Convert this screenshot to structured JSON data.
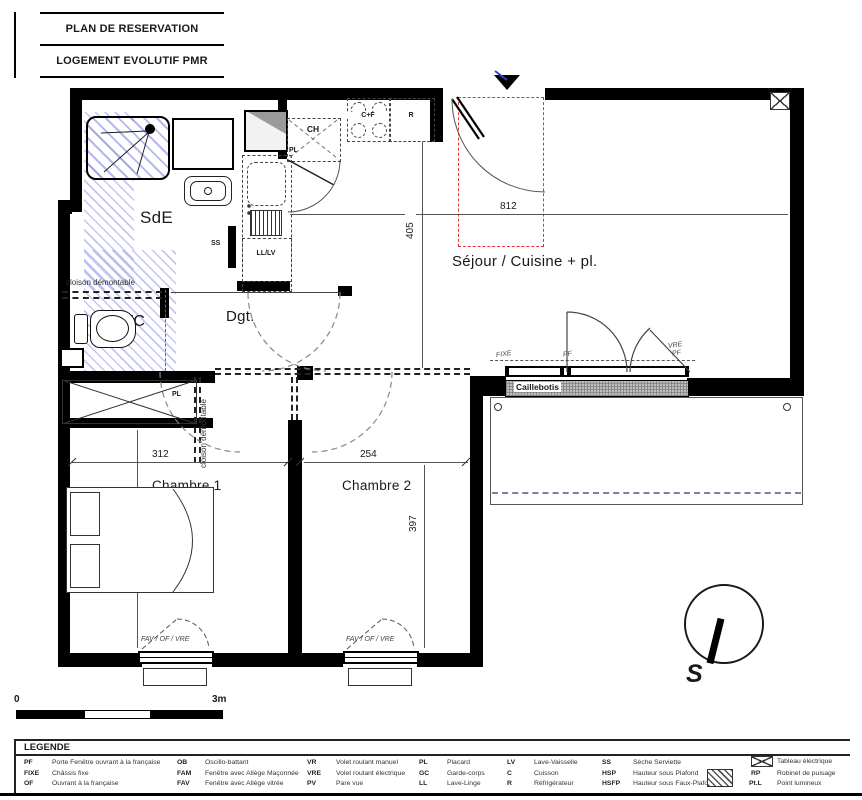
{
  "title_block": {
    "line1": "PLAN DE RESERVATION",
    "line2": "LOGEMENT EVOLUTIF PMR"
  },
  "rooms": {
    "sde": "SdE",
    "wc": "WC",
    "dgt": "Dgt.",
    "sejour": "Séjour / Cuisine + pl.",
    "chambre1": "Chambre 1",
    "chambre2": "Chambre 2",
    "terrasse": "Terrasse"
  },
  "annot": {
    "cloison": "cloison démontable",
    "ss": "SS",
    "lllv": "LL/LV",
    "ch": "CH",
    "pl_ch": "PL",
    "cf": "C+F",
    "r": "R",
    "pl": "PL",
    "caillebotis": "Caillebotis",
    "fixe": "FIXE",
    "pf": "PF",
    "vre": "VRE",
    "pf2": "PF",
    "fav": "FAV / OF / VRE",
    "compass_s": "S"
  },
  "dims": {
    "sejour_width": "812",
    "sejour_height": "405",
    "chambre1_width": "312",
    "chambre1_height": "397",
    "chambre2_width": "254",
    "chambre2_height": "397"
  },
  "scale": {
    "start": "0",
    "end": "3m"
  },
  "colors": {
    "wall": "#000000",
    "red_dashed": "#e8312a",
    "hatch_blue": "#6e6ee1",
    "terrasse_dash": "#7a7fae"
  },
  "legend": {
    "title": "LEGENDE",
    "items": [
      {
        "abbr": "PF",
        "label": "Porte Fenêtre ouvrant à la française"
      },
      {
        "abbr": "FIXE",
        "label": "Châssis fixe"
      },
      {
        "abbr": "OF",
        "label": "Ouvrant à la française"
      },
      {
        "abbr": "OB",
        "label": "Oscillo-battant"
      },
      {
        "abbr": "FAM",
        "label": "Fenêtre avec Allège Maçonnée"
      },
      {
        "abbr": "FAV",
        "label": "Fenêtre avec Allège vitrée"
      },
      {
        "abbr": "VR",
        "label": "Volet roulant manuel"
      },
      {
        "abbr": "VRE",
        "label": "Volet roulant électrique"
      },
      {
        "abbr": "PV",
        "label": "Pare vue"
      },
      {
        "abbr": "PL",
        "label": "Placard"
      },
      {
        "abbr": "GC",
        "label": "Garde-corps"
      },
      {
        "abbr": "LL",
        "label": "Lave-Linge"
      },
      {
        "abbr": "LV",
        "label": "Lave-Vaisselle"
      },
      {
        "abbr": "C",
        "label": "Cuisson"
      },
      {
        "abbr": "R",
        "label": "Réfrigérateur"
      },
      {
        "abbr": "SS",
        "label": "Sèche Serviette"
      },
      {
        "abbr": "HSP",
        "label": "Hauteur sous Plafond"
      },
      {
        "abbr": "HSFP",
        "label": "Hauteur sous Faux-Plafond"
      },
      {
        "abbr": "",
        "label": "Tableau électrique"
      },
      {
        "abbr": "RP",
        "label": "Robinet de puisage"
      },
      {
        "abbr": "Pt.L",
        "label": "Point lumineux"
      }
    ]
  }
}
